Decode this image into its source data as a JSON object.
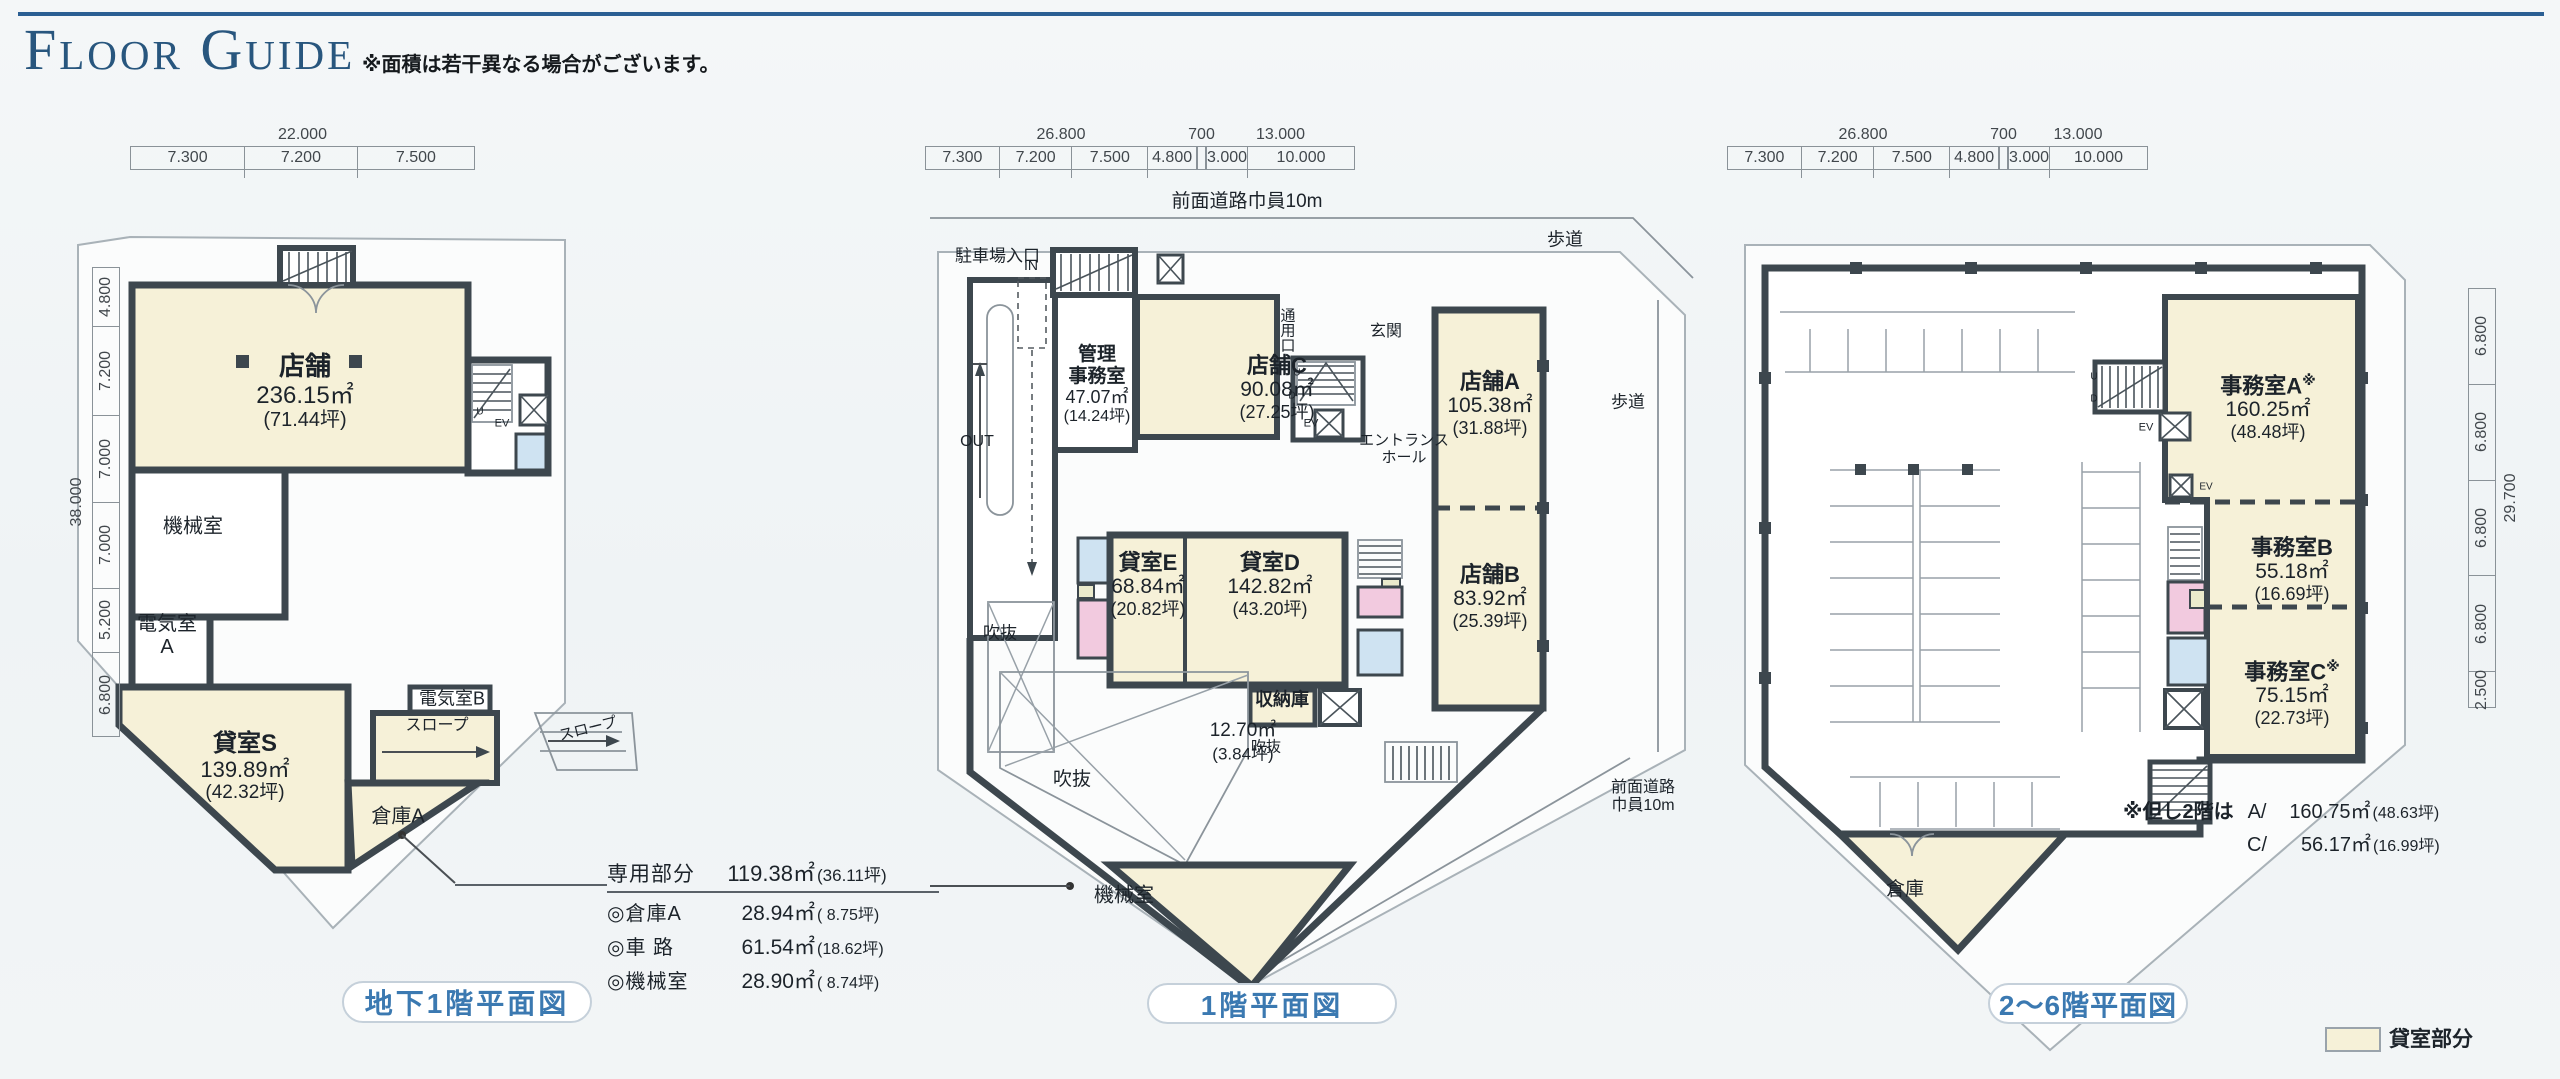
{
  "header": {
    "title": "Floor Guide",
    "note": "※面積は若干異なる場合がございます。"
  },
  "colors": {
    "accent": "#2a5f93",
    "caption_blue": "#3b79b1",
    "wall": "#3d474e",
    "room_cream": "#f6f1d8",
    "wc_pink": "#f2cadf",
    "wc_blue": "#cfe3f2",
    "site_line": "#a9b2b8"
  },
  "legend": {
    "label": "貸室部分"
  },
  "annotation": {
    "title": {
      "name": "専用部分",
      "value": "119.38㎡",
      "tsubo": "(36.11坪)"
    },
    "items": [
      {
        "name": "◎倉庫A",
        "value": "28.94㎡",
        "tsubo": "( 8.75坪)"
      },
      {
        "name": "◎車 路",
        "value": "61.54㎡",
        "tsubo": "(18.62坪)"
      },
      {
        "name": "◎機械室",
        "value": "28.90㎡",
        "tsubo": "( 8.74坪)"
      }
    ]
  },
  "plans": [
    {
      "caption": "地下1階平面図",
      "dim_top": {
        "total": "22.000",
        "segments": [
          "7.300",
          "7.200",
          "7.500"
        ]
      },
      "dim_left": {
        "total": "38.000",
        "segments": [
          "4.800",
          "7.200",
          "7.000",
          "7.000",
          "5.200",
          "6.800"
        ]
      },
      "rooms": {
        "tenpo": {
          "name": "店舗",
          "area": "236.15㎡",
          "tsubo": "(71.44坪)"
        },
        "kikai": {
          "name": "機械室"
        },
        "denki_a": {
          "line1": "電気室",
          "line2": "A"
        },
        "kashitsu_s": {
          "name": "貸室S",
          "area": "139.89㎡",
          "tsubo": "(42.32坪)"
        },
        "denki_b": {
          "name": "電気室B"
        },
        "slope_inner": {
          "name": "スロープ"
        },
        "slope_outer": {
          "name": "スロープ"
        },
        "souko_a": {
          "name": "倉庫A"
        }
      },
      "marks": {
        "u": "U",
        "ev": "EV"
      }
    },
    {
      "caption": "1階平面図",
      "dim_top": {
        "g1_total": "26.800",
        "g1_segments": [
          "7.300",
          "7.200",
          "7.500",
          "4.800"
        ],
        "g2_total": "700",
        "g3_total": "13.000",
        "g3_segments": [
          "3.000",
          "10.000"
        ]
      },
      "roads": {
        "front_top": "前面道路巾員10m",
        "walk_top": "歩道",
        "walk_right": "歩道",
        "front_right_1": "前面道路",
        "front_right_2": "巾員10m"
      },
      "labels": {
        "parking_entrance": "駐車場入口",
        "in": "IN",
        "out": "OUT",
        "passage": "通用口",
        "entrance": "玄関",
        "hall_1": "エントランス",
        "hall_2": "ホール",
        "void": "吹抜"
      },
      "rooms": {
        "kanri": {
          "line1": "管理",
          "line2": "事務室",
          "area": "47.07㎡",
          "tsubo": "(14.24坪)"
        },
        "tenpo_c": {
          "name": "店舗C",
          "area": "90.08㎡",
          "tsubo": "(27.25坪)"
        },
        "tenpo_a": {
          "name": "店舗A",
          "area": "105.38㎡",
          "tsubo": "(31.88坪)"
        },
        "tenpo_b": {
          "name": "店舗B",
          "area": "83.92㎡",
          "tsubo": "(25.39坪)"
        },
        "kashitsu_e": {
          "name": "貸室E",
          "area": "68.84㎡",
          "tsubo": "(20.82坪)"
        },
        "kashitsu_d": {
          "name": "貸室D",
          "area": "142.82㎡",
          "tsubo": "(43.20坪)"
        },
        "shunouko": {
          "name": "収納庫",
          "area": "12.70㎡",
          "tsubo": "(3.84坪)"
        },
        "kikai": {
          "name": "機械室"
        }
      },
      "marks": {
        "u": "U",
        "d": "D",
        "ev": "EV"
      }
    },
    {
      "caption": "2〜6階平面図",
      "dim_top": {
        "g1_total": "26.800",
        "g1_segments": [
          "7.300",
          "7.200",
          "7.500",
          "4.800"
        ],
        "g2_total": "700",
        "g3_total": "13.000",
        "g3_segments": [
          "3.000",
          "10.000"
        ]
      },
      "dim_right": {
        "total": "29.700",
        "segments": [
          "6.800",
          "6.800",
          "6.800",
          "6.800",
          "2.500"
        ]
      },
      "rooms": {
        "jimusho_a": {
          "name": "事務室A",
          "mark": "※",
          "area": "160.25㎡",
          "tsubo": "(48.48坪)"
        },
        "jimusho_b": {
          "name": "事務室B",
          "area": "55.18㎡",
          "tsubo": "(16.69坪)"
        },
        "jimusho_c": {
          "name": "事務室C",
          "mark": "※",
          "area": "75.15㎡",
          "tsubo": "(22.73坪)"
        },
        "souko": {
          "name": "倉庫"
        }
      },
      "note": {
        "prefix": "※但し2階は",
        "rows": [
          {
            "name": "A/",
            "value": "160.75㎡",
            "tsubo": "(48.63坪)"
          },
          {
            "name": "C/",
            "value": "56.17㎡",
            "tsubo": "(16.99坪)"
          }
        ]
      },
      "marks": {
        "u": "U",
        "d": "D",
        "ev": "EV"
      }
    }
  ]
}
